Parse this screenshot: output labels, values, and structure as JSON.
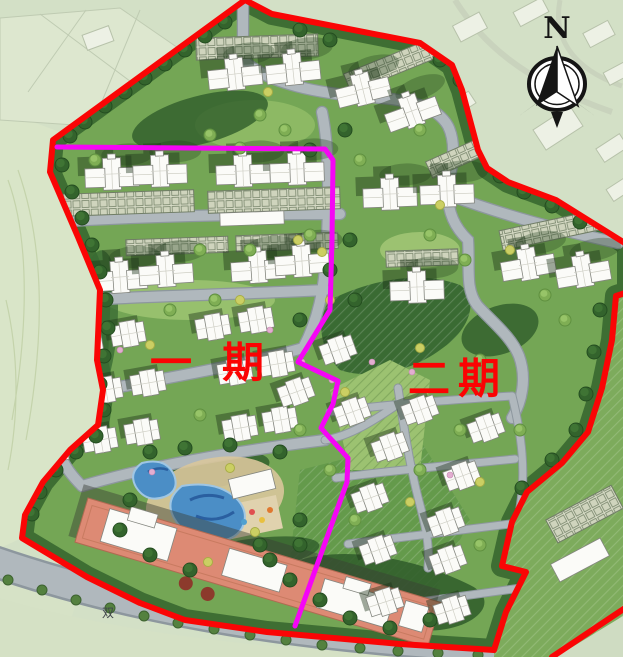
{
  "map": {
    "phase_labels": {
      "phase1": "一期",
      "phase2": "二期"
    },
    "compass": {
      "north_label": "N"
    },
    "road_label": "双"
  },
  "colors": {
    "boundary_red": "#fa0505",
    "divider_magenta": "#f505f5",
    "label_red": "#fb0303",
    "site_green": "#74a655",
    "context_green": "#d3e0c6",
    "road_gray": "#b0b8bd",
    "road_casing": "#8d979e",
    "pool_blue": "#4b8ec6",
    "clubhouse_salmon": "#dd8a74",
    "building_white": "#fbfbf8",
    "tree_dark_green": "#33632c",
    "compass_black": "#151515"
  }
}
